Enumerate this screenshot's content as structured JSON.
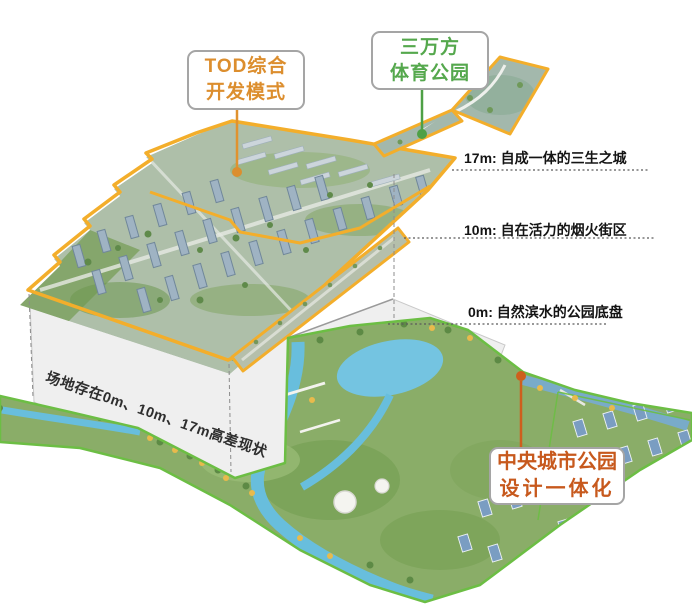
{
  "labels": {
    "tod": {
      "line1": "TOD综合",
      "line2": "开发模式",
      "color": "#DC8E2E"
    },
    "sports": {
      "line1": "三万方",
      "line2": "体育公园",
      "color": "#55A84D"
    },
    "central": {
      "line1": "中央城市公园",
      "line2": "设计一体化",
      "color": "#C7591D"
    }
  },
  "annotations": {
    "level17": "17m: 自成一体的三生之城",
    "level10": "10m: 自在活力的烟火街区",
    "level0": "0m: 自然滨水的公园底盘"
  },
  "platform": {
    "note": "场地存在0m、10m、17m高差现状"
  },
  "colors": {
    "site_outline_yellow": "#F3AE2B",
    "park_outline_green": "#6CBE44",
    "leader_orange": "#E0922F",
    "leader_green": "#4EA046",
    "leader_red_orange": "#CE5F1D",
    "annotation_text": "#141414",
    "platform_fill": "#EFEFEF",
    "water_blue": "#68BEDD"
  }
}
